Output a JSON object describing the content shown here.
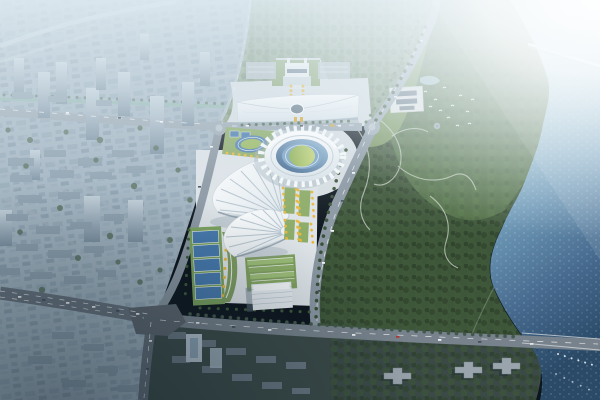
{
  "scene": {
    "name": "aerial-render-riverside-sports-complex",
    "description": "Bird's-eye architectural rendering: white expo hall, scalloped-ring stadium, two fan-shaped arenas and courts on a central plaza axis; hazy high-rise city to the west, wooded riverside park with temple compound to the east, river with two bridges on the right, large road intersection at lower left, strong sun flare from top right.",
    "landmarks": [
      "city-district",
      "city-canal",
      "gate-hall",
      "expo-hall",
      "main-stadium",
      "practice-track",
      "fan-arena-north",
      "fan-arena-south",
      "outdoor-courts",
      "terraced-green-building",
      "office-building",
      "central-axis-gardens",
      "riverside-park",
      "temple-compound",
      "park-pond",
      "forest",
      "river",
      "north-bridge",
      "east-bridge",
      "road-network",
      "roundabout",
      "residential-south",
      "boats",
      "birds"
    ]
  },
  "palette": {
    "city_base": "#a3b5c2",
    "north_green": "#8aa086",
    "plaza": "#d7dee2",
    "plaza_bright": "#dde3e7",
    "road_main": "#9aa8b3",
    "road_secondary": "#8a97a2",
    "road_dark": "#6d7984",
    "road_darker": "#5d666f",
    "park_green": "#3f5839",
    "park_light": "#567349",
    "lawn": "#7e9c5f",
    "field_green": "#8cab66",
    "court_blue": "#4679ad",
    "court_green": "#79a15c",
    "track_blue": "#4e7fae",
    "infield_green": "#98b85e",
    "tree_yellow": "#e7b73c",
    "building_white": "#e5ebef",
    "building_green": "#7f9f5e",
    "temple_wall": "#e7e8e4",
    "temple_roof": "#5d6d7c",
    "dark_zone": "#3b4a47",
    "city_south": "#4e5c66",
    "bird_white": "#ffffff",
    "marking_white": "#ffffff"
  }
}
